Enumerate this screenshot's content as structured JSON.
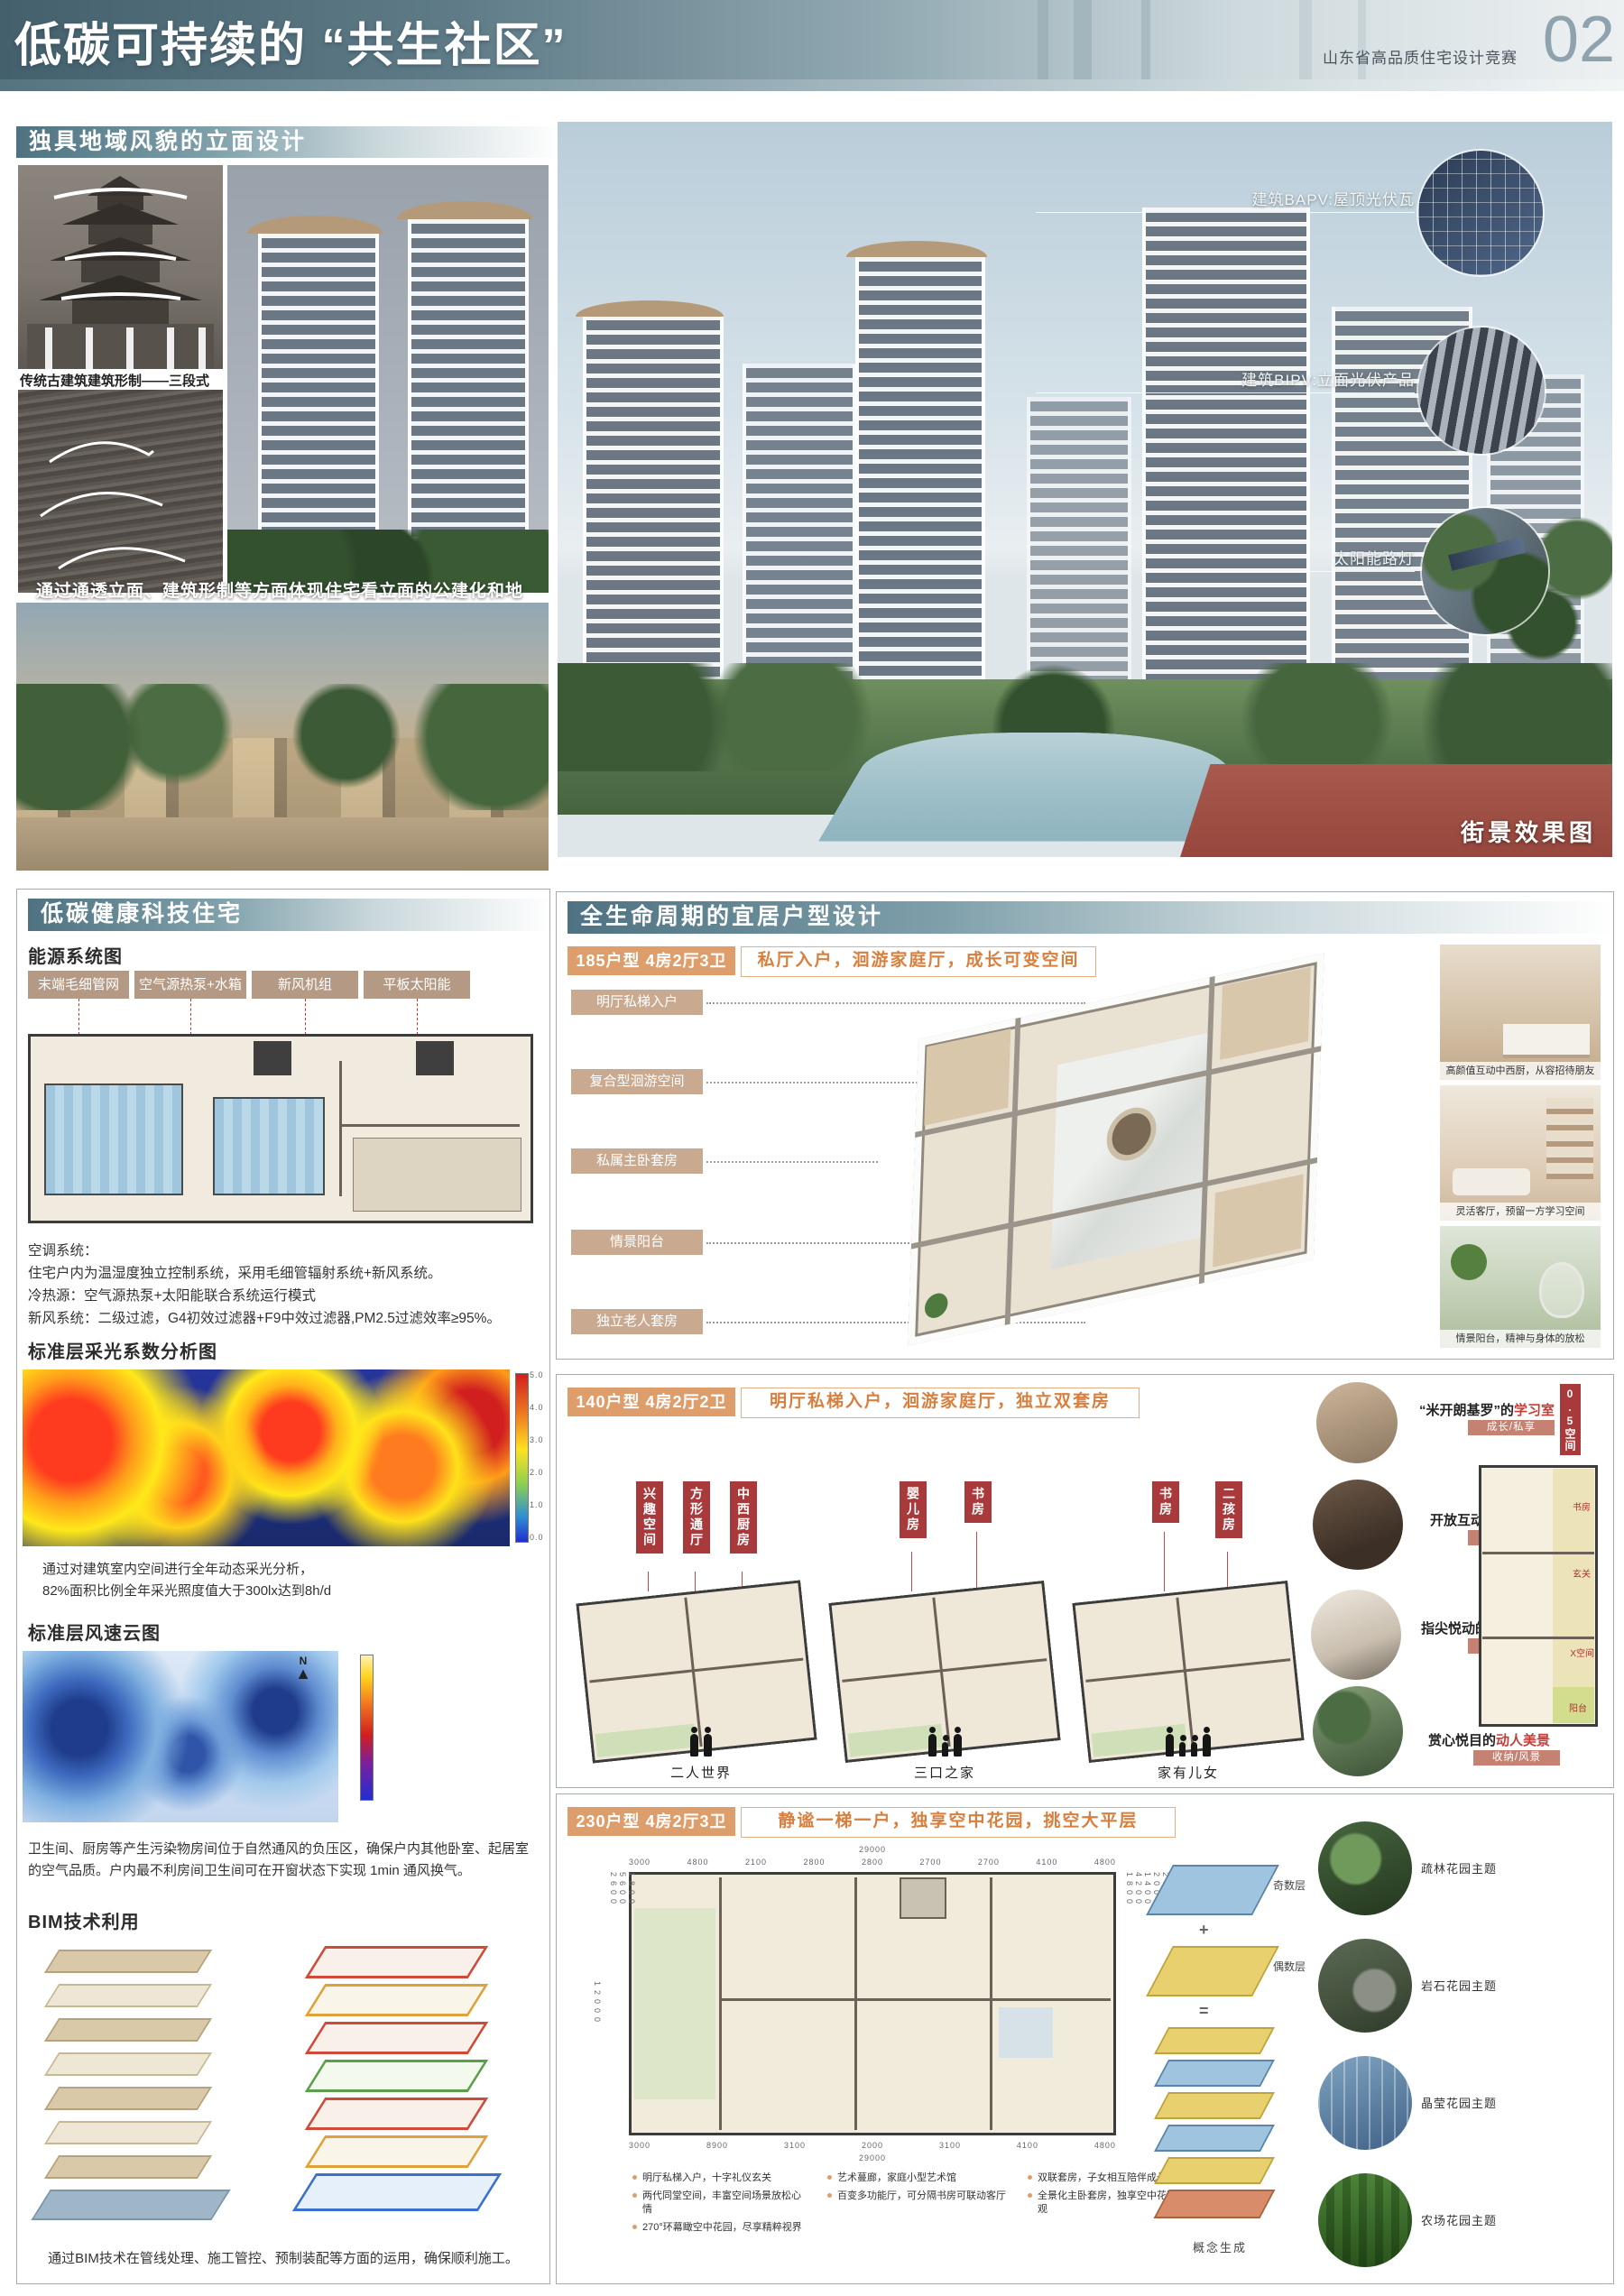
{
  "colors": {
    "header_teal": "#47626e",
    "section_bar_teal": "#4e7281",
    "tan_button": "#b49a84",
    "tan_label": "#c9aa90",
    "orange_badge": "#dd9e6b",
    "orange_text": "#d97f3e",
    "red_room_label": "#a93a3c",
    "red_highlight": "#c13f3a",
    "feature_tag": "#c58273"
  },
  "header": {
    "title": "低碳可持续的 “共生社区”",
    "competition": "山东省高品质住宅设计竞赛",
    "page_number": "02"
  },
  "facade": {
    "title": "独具地域风貌的立面设计",
    "pagoda_caption": "传统古建筑建筑形制——三段式",
    "overlay_text": "通过通透立面、建筑形制等方面体现住宅看立面的公建化和地域特色文化"
  },
  "street": {
    "label": "街景效果图",
    "annotations": [
      "建筑BAPV:屋顶光伏瓦",
      "建筑BIPV:立面光伏产品",
      "太阳能路灯"
    ]
  },
  "tech": {
    "title": "低碳健康科技住宅",
    "energy_subtitle": "能源系统图",
    "energy_buttons": [
      "末端毛细管网",
      "空气源热泵+水箱",
      "新风机组",
      "平板太阳能"
    ],
    "hvac_lines": [
      "空调系统：",
      "住宅户内为温湿度独立控制系统，采用毛细管辐射系统+新风系统。",
      "冷热源：空气源热泵+太阳能联合系统运行模式",
      "新风系统：二级过滤，G4初效过滤器+F9中效过滤器,PM2.5过滤效率≥95%。"
    ],
    "daylight_subtitle": "标准层采光系数分析图",
    "daylight_scale_ticks": [
      "5.0",
      "4.0",
      "3.0",
      "2.0",
      "1.0",
      "0.0"
    ],
    "daylight_text_line1": "通过对建筑室内空间进行全年动态采光分析，",
    "daylight_text_line2": "82%面积比例全年采光照度值大于300lx达到8h/d",
    "wind_subtitle": "标准层风速云图",
    "compass": "N",
    "wind_text": "卫生间、厨房等产生污染物房间位于自然通风的负压区，确保户内其他卧室、起居室的空气品质。户内最不利房间卫生间可在开窗状态下实现 1min 通风换气。",
    "bim_subtitle": "BIM技术利用",
    "bim_text": "通过BIM技术在管线处理、施工管控、预制装配等方面的运用，确保顺利施工。"
  },
  "layouts": {
    "title": "全生命周期的宜居户型设计",
    "plan185": {
      "badge": "185户型  4房2厅3卫",
      "tagline": "私厅入户，洄游家庭厅，成长可变空间",
      "labels": [
        "明厅私梯入户",
        "复合型洄游空间",
        "私属主卧套房",
        "情景阳台",
        "独立老人套房"
      ],
      "photo_captions": [
        "高颜值互动中西厨，从容招待朋友",
        "灵活客厅，预留一方学习空间",
        "情景阳台，精神与身体的放松"
      ]
    },
    "plan140": {
      "badge": "140户型  4房2厅2卫",
      "tagline": "明厅私梯入户，洄游家庭厅，独立双套房",
      "room_tags": [
        "兴趣空间",
        "方形通厅",
        "中西厨房",
        "婴儿房",
        "书房",
        "书房",
        "二孩房"
      ],
      "family_captions": [
        "二人世界",
        "三口之家",
        "家有儿女"
      ],
      "corner_tag": "0.5空间",
      "features": [
        {
          "prefix": "“米开朗基罗”的",
          "highlight": "学习室",
          "tag": "成长/私享"
        },
        {
          "prefix": "开放互动的",
          "highlight": "治愈厨房",
          "tag": "互动/交流"
        },
        {
          "prefix": "指尖悦动的",
          "highlight": "乐符演奏厅",
          "tag": "智能/悦己"
        },
        {
          "prefix": "赏心悦目的",
          "highlight": "动人美景",
          "tag": "收纳/风景"
        }
      ],
      "mini_plan_rooms": [
        "书房",
        "玄关",
        "X空间",
        "阳台"
      ]
    },
    "plan230": {
      "badge": "230户型  4房2厅3卫",
      "tagline": "静谧一梯一户，独享空中花园，挑空大平层",
      "dims_top_total": "29000",
      "dims_top": [
        "3000",
        "4800",
        "2100",
        "2800",
        "2800",
        "2700",
        "2700",
        "4100",
        "4800"
      ],
      "dims_bottom": [
        "3000",
        "8900",
        "3100",
        "2000",
        "3100",
        "4100",
        "4800"
      ],
      "dims_bottom_total": "29000",
      "dims_left_total": "12000",
      "dims_left": [
        "1800",
        "5600",
        "2600"
      ],
      "dims_right": [
        "2600",
        "2000",
        "1400",
        "4200",
        "1800"
      ],
      "bullets": [
        "明厅私梯入户，十字礼仪玄关",
        "两代同堂空间，丰富空间场景放松心情",
        "270°环幕瞰空中花园，尽享精粹视界",
        "艺术蔓廊，家庭小型艺术馆",
        "百变多功能厅，可分隔书房可联动客厅",
        "双联套房，子女相互陪伴成长",
        "全景化主卧套房，独享空中花园景观"
      ],
      "diagram": {
        "odd": "奇数层",
        "plus": "+",
        "even": "偶数层",
        "equals": "=",
        "caption": "概念生成"
      },
      "gardens": [
        "疏林花园主题",
        "岩石花园主题",
        "晶莹花园主题",
        "农场花园主题"
      ]
    }
  }
}
